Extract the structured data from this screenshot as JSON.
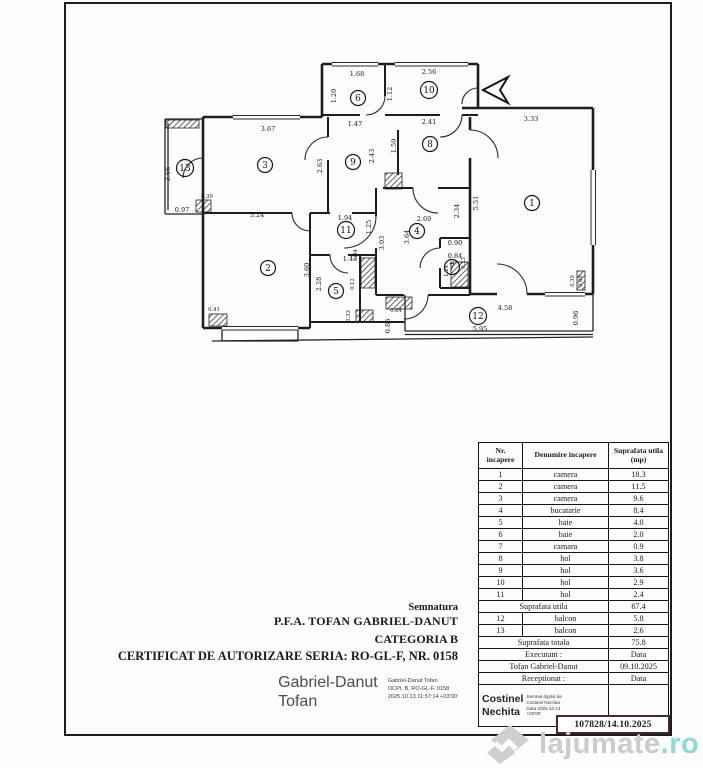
{
  "certificate": {
    "signature_label": "Semnatura",
    "authority": "P.F.A. TOFAN GABRIEL-DANUT",
    "category": "CATEGORIA B",
    "certificate_line": "CERTIFICAT DE AUTORIZARE SERIA: RO-GL-F, NR. 0158",
    "signer_name_line1": "Gabriel-Danut",
    "signer_name_line2": "Tofan",
    "stamp_lines": [
      "Gabriel-Danut Tofan",
      "OCPI, B, RO-GL-F, 0158",
      "2025.10.13 11:57:14 +03'00'"
    ]
  },
  "table": {
    "col1_header_line1": "Nr.",
    "col1_header_line2": "incapere",
    "col2_header": "Denumire incapere",
    "col3_header_line1": "Suprafata utila",
    "col3_header_line2": "(mp)",
    "rows": [
      {
        "nr": "1",
        "name": "camera",
        "area": "18.3"
      },
      {
        "nr": "2",
        "name": "camera",
        "area": "11.5"
      },
      {
        "nr": "3",
        "name": "camera",
        "area": "9.6"
      },
      {
        "nr": "4",
        "name": "bucatarie",
        "area": "8.4"
      },
      {
        "nr": "5",
        "name": "baie",
        "area": "4.0"
      },
      {
        "nr": "6",
        "name": "baie",
        "area": "2.0"
      },
      {
        "nr": "7",
        "name": "camara",
        "area": "0.9"
      },
      {
        "nr": "8",
        "name": "hol",
        "area": "3.8"
      },
      {
        "nr": "9",
        "name": "hol",
        "area": "3.6"
      },
      {
        "nr": "10",
        "name": "hol",
        "area": "2.9"
      },
      {
        "nr": "11",
        "name": "hol",
        "area": "2.4"
      }
    ],
    "subtotal": {
      "label": "Suprafata utila",
      "value": "67.4"
    },
    "balcony_rows": [
      {
        "nr": "12",
        "name": "balcon",
        "area": "5.8"
      },
      {
        "nr": "13",
        "name": "balcon",
        "area": "2.6"
      }
    ],
    "total": {
      "label": "Suprafata totala",
      "value": "75.8"
    },
    "executant": {
      "label": "Executant :",
      "value": "Data"
    },
    "executant_name": {
      "label": "Tofan Gabriel-Danut",
      "value": "09.10.2025"
    },
    "receptionat": {
      "label": "Receptionat :",
      "value": "Data"
    },
    "stamp": {
      "name_line1": "Costinel",
      "name_line2": "Nechita",
      "lines": [
        "Semnat digital de",
        "Costinel Nechita",
        "Data 2025.10.14",
        "+03'00'"
      ]
    },
    "registration": "107828/14.10.2025"
  },
  "watermark": {
    "brand": "lajumate",
    "tld": ".ro"
  },
  "plan": {
    "rooms": [
      {
        "n": "1",
        "x": 532,
        "y": 203
      },
      {
        "n": "2",
        "x": 268,
        "y": 268
      },
      {
        "n": "3",
        "x": 265,
        "y": 165
      },
      {
        "n": "4",
        "x": 417,
        "y": 231
      },
      {
        "n": "5",
        "x": 336,
        "y": 291
      },
      {
        "n": "6",
        "x": 358,
        "y": 98
      },
      {
        "n": "7",
        "x": 452,
        "y": 267
      },
      {
        "n": "8",
        "x": 430,
        "y": 144
      },
      {
        "n": "9",
        "x": 353,
        "y": 162
      },
      {
        "n": "10",
        "x": 429,
        "y": 90
      },
      {
        "n": "11",
        "x": 346,
        "y": 230
      },
      {
        "n": "12",
        "x": 478,
        "y": 316
      },
      {
        "n": "13",
        "x": 185,
        "y": 168
      }
    ],
    "dims": [
      {
        "t": "1.68",
        "x": 357,
        "y": 76
      },
      {
        "t": "2.56",
        "x": 429,
        "y": 74
      },
      {
        "t": "1.20",
        "x": 336,
        "y": 96,
        "v": true
      },
      {
        "t": "1.12",
        "x": 392,
        "y": 94,
        "v": true
      },
      {
        "t": "2.41",
        "x": 429,
        "y": 124
      },
      {
        "t": "1.47",
        "x": 355,
        "y": 126
      },
      {
        "t": "1.59",
        "x": 396,
        "y": 146,
        "v": true
      },
      {
        "t": "2.43",
        "x": 374,
        "y": 156,
        "v": true
      },
      {
        "t": "2.63",
        "x": 322,
        "y": 166,
        "v": true
      },
      {
        "t": "3.67",
        "x": 268,
        "y": 131
      },
      {
        "t": "3.33",
        "x": 531,
        "y": 121
      },
      {
        "t": "2.66",
        "x": 170,
        "y": 174,
        "v": true
      },
      {
        "t": "0.97",
        "x": 182,
        "y": 212
      },
      {
        "t": "0.39",
        "x": 207,
        "y": 198,
        "s": true
      },
      {
        "t": "3.24",
        "x": 257,
        "y": 217
      },
      {
        "t": "1.94",
        "x": 345,
        "y": 220
      },
      {
        "t": "1.25",
        "x": 371,
        "y": 227,
        "v": true
      },
      {
        "t": "2.69",
        "x": 424,
        "y": 221
      },
      {
        "t": "3.03",
        "x": 384,
        "y": 243,
        "v": true
      },
      {
        "t": "3.64",
        "x": 409,
        "y": 237,
        "v": true
      },
      {
        "t": "2.34",
        "x": 459,
        "y": 211,
        "v": true
      },
      {
        "t": "5.51",
        "x": 478,
        "y": 203,
        "v": true
      },
      {
        "t": "0.90",
        "x": 455,
        "y": 245
      },
      {
        "t": "0.84",
        "x": 455,
        "y": 258
      },
      {
        "t": "0.23",
        "x": 465,
        "y": 263,
        "v": true,
        "s": true
      },
      {
        "t": "1.24",
        "x": 448,
        "y": 271,
        "v": true,
        "s": true
      },
      {
        "t": "1.47",
        "x": 350,
        "y": 261
      },
      {
        "t": "3.60",
        "x": 309,
        "y": 270,
        "v": true
      },
      {
        "t": "2.28",
        "x": 321,
        "y": 284,
        "v": true
      },
      {
        "t": "0.64",
        "x": 357,
        "y": 255,
        "v": true,
        "s": true
      },
      {
        "t": "0.41",
        "x": 214,
        "y": 311,
        "s": true
      },
      {
        "t": "0.33",
        "x": 350,
        "y": 316,
        "v": true,
        "s": true
      },
      {
        "t": "0.64",
        "x": 396,
        "y": 312,
        "s": true
      },
      {
        "t": "0.86",
        "x": 390,
        "y": 326,
        "v": true
      },
      {
        "t": "4.58",
        "x": 505,
        "y": 310
      },
      {
        "t": "5.95",
        "x": 480,
        "y": 331
      },
      {
        "t": "0.96",
        "x": 578,
        "y": 318,
        "v": true
      },
      {
        "t": "0.39",
        "x": 574,
        "y": 281,
        "v": true,
        "s": true
      },
      {
        "t": "0.08",
        "x": 582,
        "y": 281,
        "v": true,
        "s": true
      },
      {
        "t": "0.12",
        "x": 354,
        "y": 284,
        "v": true,
        "s": true
      }
    ]
  }
}
